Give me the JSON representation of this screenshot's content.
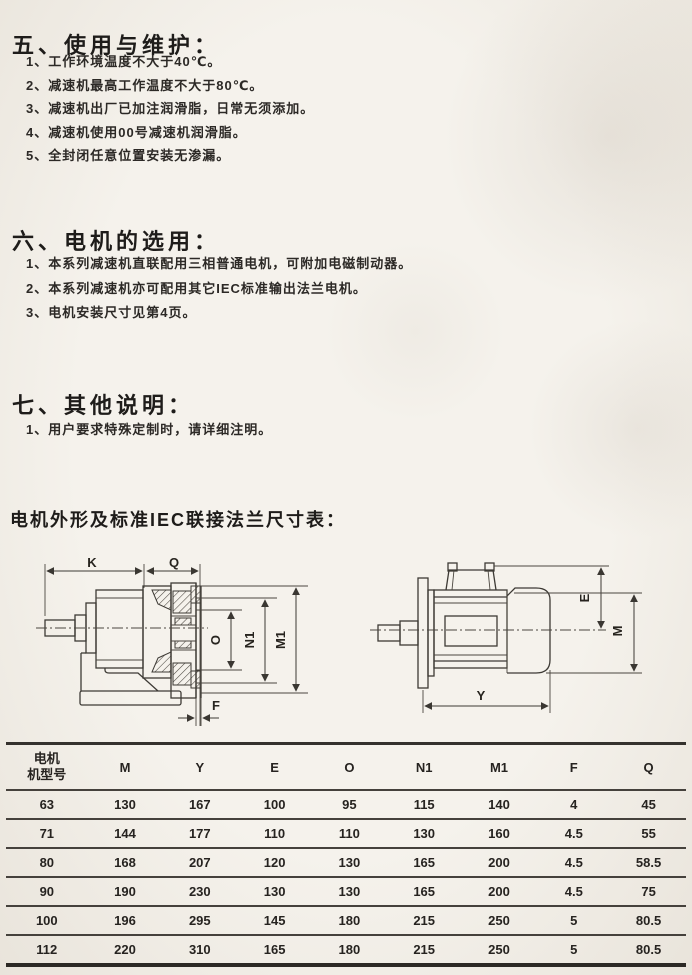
{
  "sections": [
    {
      "heading": "五、使用与维护：",
      "items": [
        "1、工作环境温度不大于40℃。",
        "2、减速机最高工作温度不大于80℃。",
        "3、减速机出厂已加注润滑脂，日常无须添加。",
        "4、减速机使用00号减速机润滑脂。",
        "5、全封闭任意位置安装无渗漏。"
      ]
    },
    {
      "heading": "六、电机的选用：",
      "items": [
        "1、本系列减速机直联配用三相普通电机，可附加电磁制动器。",
        "2、本系列减速机亦可配用其它IEC标准输出法兰电机。",
        "3、电机安装尺寸见第4页。"
      ]
    },
    {
      "heading": "七、其他说明：",
      "items": [
        "1、用户要求特殊定制时，请详细注明。"
      ]
    }
  ],
  "dimension_table_title": "电机外形及标准IEC联接法兰尺寸表：",
  "drawing_left": {
    "dims": {
      "k": "K",
      "q": "Q",
      "o": "O",
      "n1": "N1",
      "m1": "M1",
      "f": "F"
    }
  },
  "drawing_right": {
    "dims": {
      "e": "E",
      "m": "M",
      "y": "Y"
    }
  },
  "table": {
    "col1_header": {
      "line1": "电机",
      "line2": "机型号"
    },
    "headers": [
      "M",
      "Y",
      "E",
      "O",
      "N1",
      "M1",
      "F",
      "Q"
    ],
    "rows": [
      [
        "63",
        "130",
        "167",
        "100",
        "95",
        "115",
        "140",
        "4",
        "45"
      ],
      [
        "71",
        "144",
        "177",
        "110",
        "110",
        "130",
        "160",
        "4.5",
        "55"
      ],
      [
        "80",
        "168",
        "207",
        "120",
        "130",
        "165",
        "200",
        "4.5",
        "58.5"
      ],
      [
        "90",
        "190",
        "230",
        "130",
        "130",
        "165",
        "200",
        "4.5",
        "75"
      ],
      [
        "100",
        "196",
        "295",
        "145",
        "180",
        "215",
        "250",
        "5",
        "80.5"
      ],
      [
        "112",
        "220",
        "310",
        "165",
        "180",
        "215",
        "250",
        "5",
        "80.5"
      ]
    ]
  },
  "colors": {
    "paper": "#f3f0ea",
    "ink": "#2a2725"
  }
}
